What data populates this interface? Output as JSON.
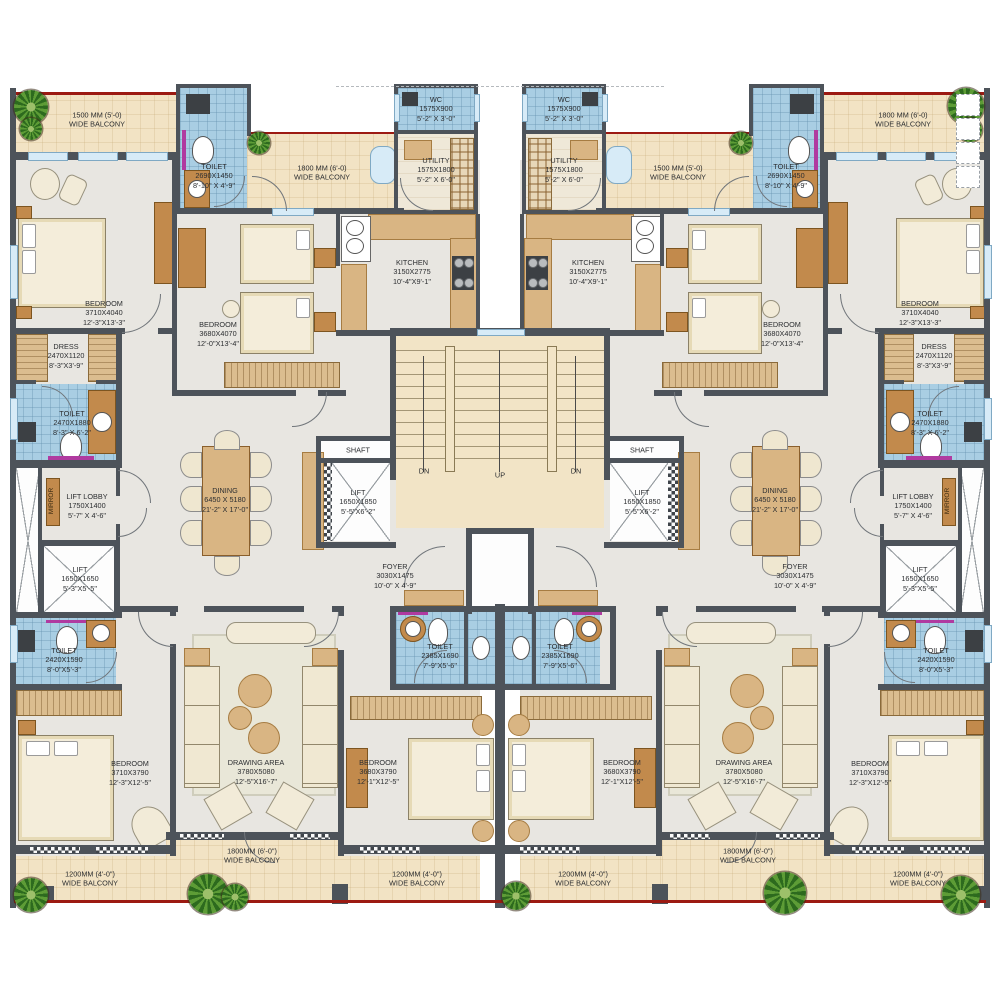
{
  "palette": {
    "wall": "#4d535a",
    "floor": "#e8e6e1",
    "balcony": "#f2e3c4",
    "toilet_blue": "#a9cee3",
    "accent_red": "#9c1a12",
    "magenta": "#b03aa0",
    "furniture_brown": "#c28a4c",
    "furniture_cream": "#f2ebd8",
    "plant_green": "#5d9c36"
  },
  "labels": {
    "balcony_1500_top": "1500 MM (5'-0)\nWIDE BALCONY",
    "balcony_1800_top": "1800 MM (6'-0)\nWIDE BALCONY",
    "toilet_entry": "TOILET\n2690X1450\n8'-10\" X 4'-9\"",
    "wc": "WC\n1575X900\n5'-2\" X 3'-0\"",
    "utility": "UTILITY\n1575X1800\n5'-2\" X 6'-0\"",
    "kitchen": "KITCHEN\n3150X2775\n10'-4\"X9'-1\"",
    "bedroom_master": "BEDROOM\n3710X4040\n12'-3\"X13'-3\"",
    "bedroom_kids": "BEDROOM\n3680X4070\n12'-0\"X13'-4\"",
    "dress": "DRESS\n2470X1120\n8'-3\"X3'-9\"",
    "toilet_master": "TOILET\n2470X1880\n8'-3\" X 6'-2\"",
    "mirror": "MIRROR",
    "lift_lobby": "LIFT LOBBY\n1750X1400\n5'-7\" X 4'-6\"",
    "lift_small": "LIFT\n1650X1650\n5'-3\"X5'-5\"",
    "dining": "DINING\n6450 X 5180\n21'-2\" X 17'-0\"",
    "shaft": "SHAFT",
    "lift_main": "LIFT\n1650X1850\n5'-5\"X6'-2\"",
    "foyer": "FOYER\n3030X1475\n10'-0\" X 4'-9\"",
    "up": "UP",
    "dn": "DN",
    "toilet_guest": "TOILET\n2420X1590\n8'-0\"X5'-3\"",
    "bedroom_guest": "BEDROOM\n3710X3790\n12'-3\"X12'-5\"",
    "drawing_area": "DRAWING AREA\n3780X5080\n12'-5\"X16'-7\"",
    "toilet_common": "TOILET\n2385X1690\n7'-9\"X5'-6\"",
    "bedroom_second": "BEDROOM\n3680X3790\n12'-1\"X12'-5\"",
    "balcony_1200_bottom": "1200MM (4'-0\")\nWIDE BALCONY",
    "balcony_1800_bottom": "1800MM (6'-0\")\nWIDE BALCONY"
  }
}
